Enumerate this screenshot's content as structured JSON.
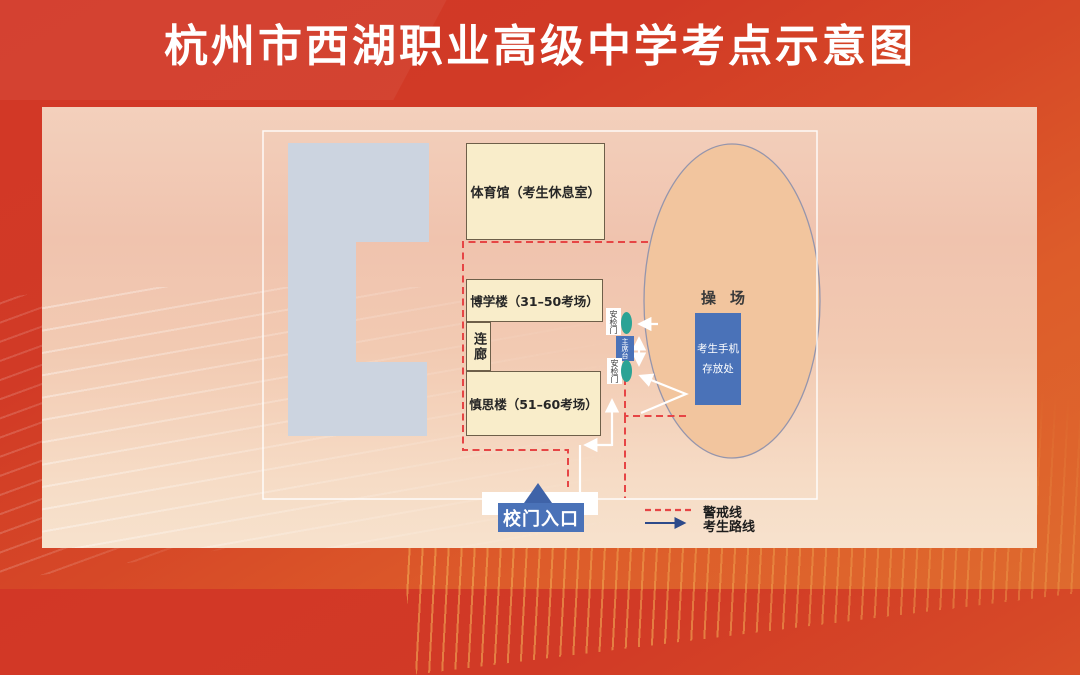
{
  "title": "杭州市西湖职业高级中学考点示意图",
  "map": {
    "buildings": {
      "gym_label": "体育馆（考生休息室）",
      "boxue_label": "博学楼（31–50考场）",
      "corridor_label": "连廊",
      "shensi_label": "慎思楼（51–60考场）"
    },
    "playground_label": "操场",
    "phone_storage": {
      "line1": "考生手机",
      "line2": "存放处"
    },
    "rostrum_label": "主席台",
    "security_gate_label": "安检门",
    "school_gate_label": "校门入口"
  },
  "legend": {
    "warning_label": "警戒线",
    "route_label": "考生路线"
  },
  "colors": {
    "banner_red": "#d23726",
    "panel_pink": "#f2cab4",
    "building_cream": "#f9edca",
    "building_gray": "#ccd4e0",
    "playground_tan": "#f2c59e",
    "accent_blue": "#4a72b8",
    "door_teal": "#2ba395",
    "warning_red": "#e64545",
    "route_navy": "#2d4a8a"
  }
}
